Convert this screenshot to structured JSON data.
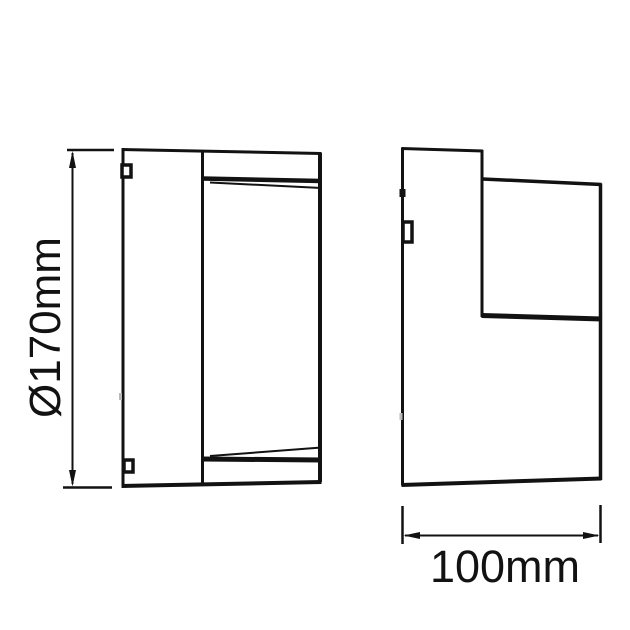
{
  "colors": {
    "background": "#ffffff",
    "line": "#121212"
  },
  "dimensions": {
    "height_label": "Ø170mm",
    "depth_label": "100mm"
  }
}
